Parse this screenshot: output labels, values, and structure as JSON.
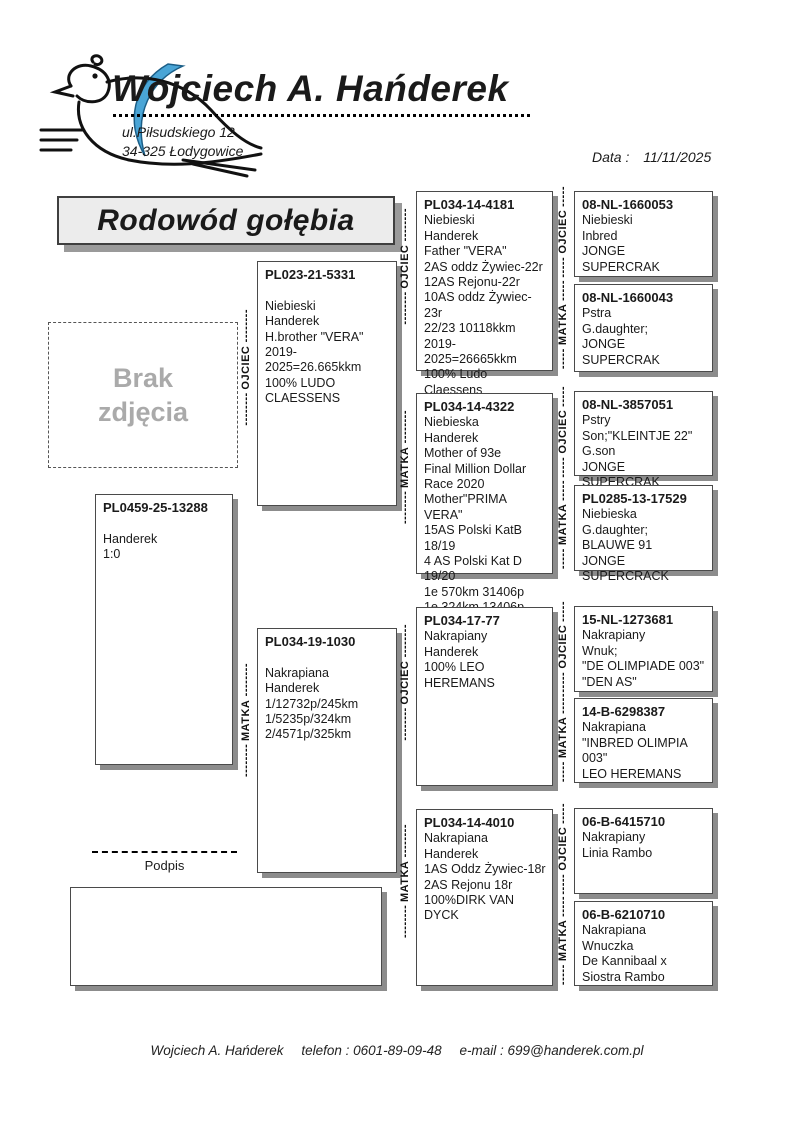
{
  "header": {
    "name": "Wojciech A. Hańderek",
    "address": [
      "ul.Piłsudskiego 12",
      "34-325 Łodygowice"
    ],
    "date_label": "Data :",
    "date_value": "11/11/2025"
  },
  "title": "Rodowód gołębia",
  "photo_placeholder": [
    "Brak",
    "zdjęcia"
  ],
  "labels": {
    "father": "OJCIEC",
    "mother": "MATKA",
    "leader_long": "--------",
    "leader_short": "-----",
    "signature": "Podpis"
  },
  "subject": {
    "ring": "PL0459-25-13288",
    "lines": [
      "",
      "Handerek",
      "1:0"
    ]
  },
  "pedigree": {
    "gen1": [
      {
        "ring": "PL023-21-5331",
        "lines": [
          "",
          "Niebieski",
          "Handerek",
          "H.brother \"VERA\"",
          "2019-2025=26.665kkm",
          "100% LUDO",
          "CLAESSENS"
        ]
      },
      {
        "ring": "PL034-19-1030",
        "lines": [
          "",
          "Nakrapiana",
          "Handerek",
          "1/12732p/245km",
          "1/5235p/324km",
          "2/4571p/325km"
        ]
      }
    ],
    "gen2": [
      {
        "ring": "PL034-14-4181",
        "lines": [
          "Niebieski",
          "Handerek",
          "Father \"VERA\"",
          "2AS oddz Żywiec-22r",
          "12AS Rejonu-22r",
          "10AS oddz Żywiec-23r",
          "22/23 10118kkm",
          "2019-2025=26665kkm",
          "100% Ludo Claessens",
          "Inbred",
          "Jonge Supercrak"
        ]
      },
      {
        "ring": "PL034-14-4322",
        "lines": [
          "Niebieska",
          "Handerek",
          "Mother of 93e",
          "Final Million Dollar",
          "Race 2020",
          "Mother\"PRIMA VERA\"",
          "15AS Polski KatB 18/19",
          "4 AS Polski Kat D 19/20",
          "1e 570km 31406p",
          "1e 324km 13406p",
          "1e 306km 3937p"
        ]
      },
      {
        "ring": "PL034-17-77",
        "lines": [
          "Nakrapiany",
          "Handerek",
          "100% LEO HEREMANS"
        ]
      },
      {
        "ring": "PL034-14-4010",
        "lines": [
          "Nakrapiana",
          "Handerek",
          "1AS Oddz Żywiec-18r",
          "2AS Rejonu 18r",
          "100%DIRK VAN DYCK"
        ]
      }
    ],
    "gen3": [
      {
        "ring": "08-NL-1660053",
        "lines": [
          "Niebieski",
          "Inbred",
          "JONGE SUPERCRAK"
        ]
      },
      {
        "ring": "08-NL-1660043",
        "lines": [
          "Pstra",
          "G.daughter;",
          "JONGE SUPERCRAK"
        ]
      },
      {
        "ring": "08-NL-3857051",
        "lines": [
          "Pstry",
          "Son;\"KLEINTJE 22\"",
          "G.son",
          "JONGE SUPERCRAK"
        ]
      },
      {
        "ring": "PL0285-13-17529",
        "lines": [
          "Niebieska",
          "G.daughter;",
          "BLAUWE 91",
          "JONGE SUPERCRACK"
        ]
      },
      {
        "ring": "15-NL-1273681",
        "lines": [
          "Nakrapiany",
          "Wnuk;",
          "\"DE OLIMPIADE 003\"",
          "\"DEN AS\""
        ]
      },
      {
        "ring": "14-B-6298387",
        "lines": [
          "Nakrapiana",
          "\"INBRED OLIMPIA 003\"",
          "LEO HEREMANS"
        ]
      },
      {
        "ring": "06-B-6415710",
        "lines": [
          "Nakrapiany",
          "Linia Rambo"
        ]
      },
      {
        "ring": "06-B-6210710",
        "lines": [
          "Nakrapiana",
          "Wnuczka",
          "De Kannibaal x",
          "Siostra Rambo"
        ]
      }
    ]
  },
  "footer": {
    "name": "Wojciech A. Hańderek",
    "phone": "telefon : 0601-89-09-48",
    "email": "e-mail : 699@handerek.com.pl"
  }
}
